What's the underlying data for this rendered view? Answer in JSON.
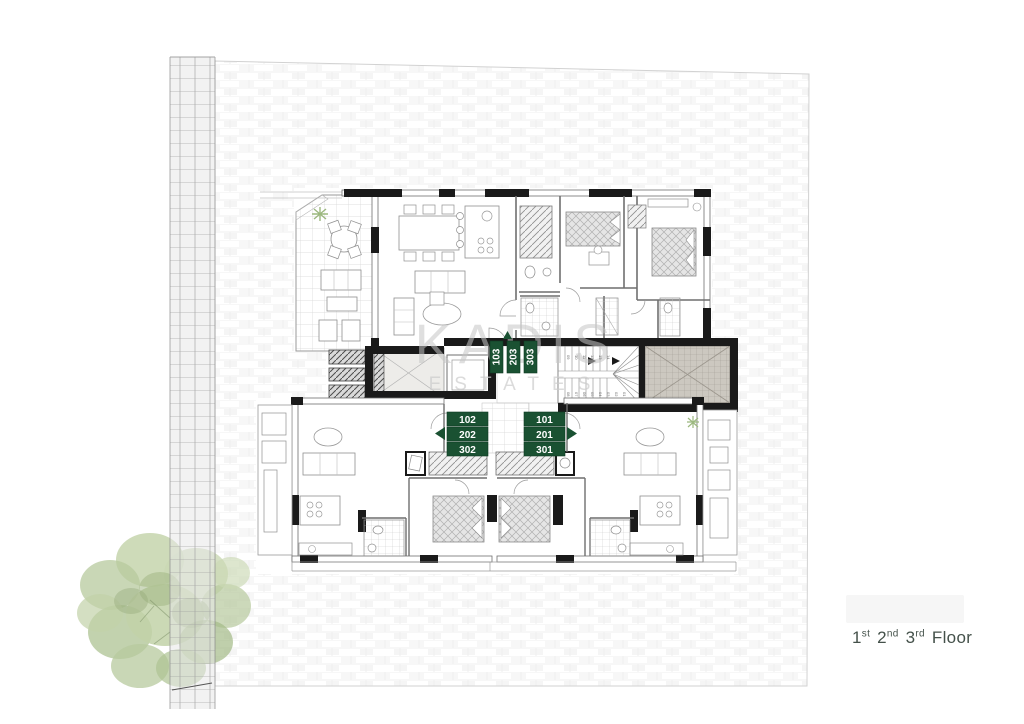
{
  "watermark": {
    "brand": "KADIS",
    "sub": "ESTATES"
  },
  "floor_label": {
    "n1": "1",
    "s1": "st",
    "n2": "2",
    "s2": "nd",
    "n3": "3",
    "s3": "rd",
    "word": "Floor"
  },
  "badges": {
    "color": "#1a5132",
    "text_color": "#ffffff",
    "top_stack": {
      "items": [
        "103",
        "203",
        "303"
      ]
    },
    "left_stack": {
      "items": [
        "102",
        "202",
        "302"
      ]
    },
    "right_stack": {
      "items": [
        "101",
        "201",
        "301"
      ]
    }
  },
  "stairs": {
    "up_run": [
      "09",
      "10",
      "11",
      "12",
      "13",
      "14"
    ],
    "down_run": [
      "01",
      "02",
      "03",
      "04",
      "05",
      "06",
      "07",
      "08"
    ]
  },
  "colors": {
    "wall_black": "#1a1a1a",
    "wall_thin": "#6f6f6f",
    "badge_green": "#1a5132",
    "label_text": "#44514a",
    "tree_green": "#b7c99d"
  }
}
